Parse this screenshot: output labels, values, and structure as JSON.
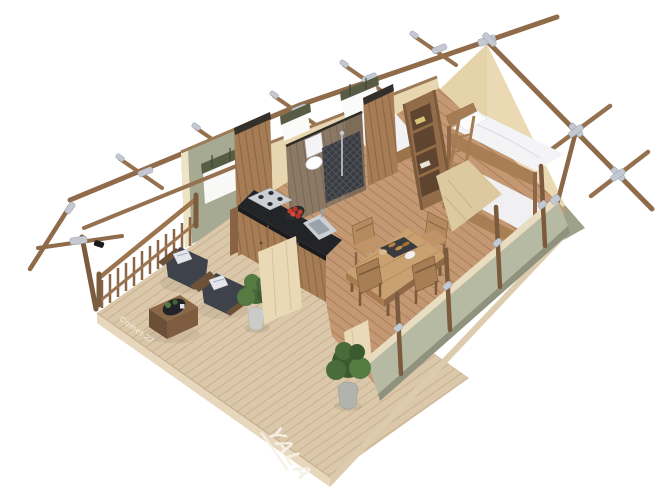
{
  "scene": {
    "description": "3D isometric cutaway rendering of a glamping safari lodge tent with the roof removed, viewed from above on a white background",
    "background": "#ffffff"
  },
  "branding": {
    "logo_text": "YALA",
    "model_text": "Comet 27"
  },
  "palette": {
    "background": "#ffffff",
    "canvas_beige": "#e7d6b0",
    "canvas_beige_gable": "#ead9b2",
    "canvas_sage_exterior": "#a7aa92",
    "canvas_sage_interior": "#b7baa2",
    "canvas_olive_roll": "#575c44",
    "wood_pole": "#8f6b4a",
    "wood_walnut_furniture": "#6e5238",
    "wood_oak_furniture": "#b08a5e",
    "wood_deck": "#dbc7a9",
    "wood_interior_floor": "#c49872",
    "metal_connector": "#c4c9d1",
    "countertop_black": "#232428",
    "stainless_steel": "#c9ced3",
    "cushion_charcoal": "#3d424a",
    "bedding_white": "#f3f3f5",
    "plant_green": "#4c6b3a",
    "fruit_red": "#c23d30",
    "logo_paint_white": "#f6f1e4"
  },
  "structure": {
    "frame": "wooden poles with galvanized steel connectors",
    "window_count": 3,
    "walls": [
      "sage green canvas exterior",
      "beige canvas interior"
    ]
  },
  "rooms": [
    {
      "name": "deck-veranda",
      "objects": [
        "wood-railing",
        "lounge-chair",
        "lounge-chair",
        "coffee-table",
        "potted-plant",
        "potted-plant",
        "canvas-door-flap"
      ]
    },
    {
      "name": "kitchen",
      "objects": [
        "gas-hob",
        "fruit-bowl",
        "sink",
        "black-countertop",
        "wood-cabinets"
      ]
    },
    {
      "name": "bathroom",
      "objects": [
        "toilet",
        "shower"
      ]
    },
    {
      "name": "single-bedroom",
      "objects": [
        "single-bed",
        "ladder-shelf",
        "wood-divider"
      ]
    },
    {
      "name": "bunk-bedroom",
      "objects": [
        "bunk-bed",
        "bunk-ladder",
        "canvas-divider"
      ]
    },
    {
      "name": "dining-area",
      "objects": [
        "dining-table",
        "dining-chair",
        "dining-chair",
        "dining-chair",
        "dining-chair",
        "food-tray"
      ]
    }
  ]
}
